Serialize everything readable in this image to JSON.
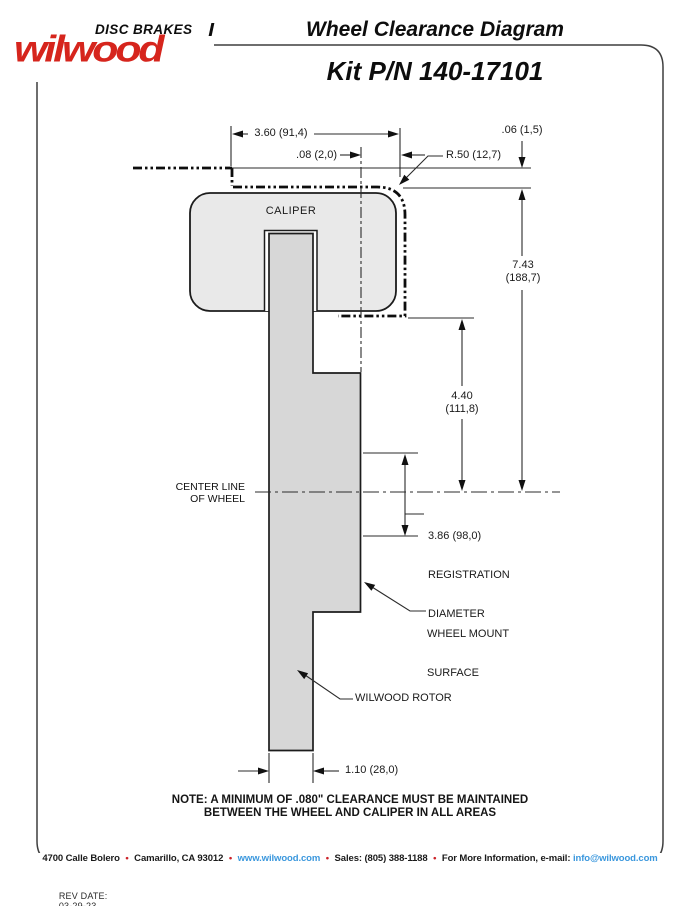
{
  "colors": {
    "logo_red": "#d6251d",
    "bullet_red": "#cc2229",
    "link_blue": "#3a97dd",
    "caliper_gray": "#e9e9e9",
    "rotor_gray": "#d7d7d7",
    "line_black": "#1c1c1c",
    "frame_gray": "#3f3f3f"
  },
  "logo": {
    "tagline": "DISC BRAKES",
    "brand": "wilwood"
  },
  "header": {
    "title": "Wheel Clearance Diagram",
    "kit_pn": "Kit P/N 140-17101"
  },
  "diagram": {
    "caliper_label": "CALIPER",
    "rotor_label": "WILWOOD ROTOR",
    "center_line_label_1": "CENTER LINE",
    "center_line_label_2": "OF WHEEL",
    "wheel_mount_label_1": "WHEEL MOUNT",
    "wheel_mount_label_2": "SURFACE",
    "registration_value": "3.86 (98,0)",
    "registration_label_1": "REGISTRATION",
    "registration_label_2": "DIAMETER",
    "dim_caliper_width": "3.60 (91,4)",
    "dim_side_clearance": ".08 (2,0)",
    "dim_top_clearance": ".06 (1,5)",
    "dim_corner_radius": "R.50 (12,7)",
    "dim_overall_height_in": "7.43",
    "dim_overall_height_mm": "(188,7)",
    "dim_mount_to_center_in": "4.40",
    "dim_mount_to_center_mm": "(111,8)",
    "dim_rotor_thickness": "1.10 (28,0)"
  },
  "note": {
    "line1": "NOTE: A MINIMUM OF .080\" CLEARANCE MUST BE MAINTAINED",
    "line2": "BETWEEN THE WHEEL AND CALIPER IN ALL AREAS"
  },
  "footer": {
    "parts": [
      {
        "type": "text",
        "text": "4700 Calle Bolero"
      },
      {
        "type": "bullet",
        "text": "•"
      },
      {
        "type": "text",
        "text": "Camarillo, CA 93012"
      },
      {
        "type": "bullet",
        "text": "•"
      },
      {
        "type": "link",
        "text": "www.wilwood.com"
      },
      {
        "type": "bullet",
        "text": "•"
      },
      {
        "type": "text",
        "text": "Sales: (805) 388-1188"
      },
      {
        "type": "bullet",
        "text": "•"
      },
      {
        "type": "text",
        "text": "For More Information, e-mail:"
      },
      {
        "type": "link",
        "text": "info@wilwood.com"
      }
    ]
  },
  "rev": {
    "label": "REV DATE:",
    "date": "03-29-23"
  }
}
